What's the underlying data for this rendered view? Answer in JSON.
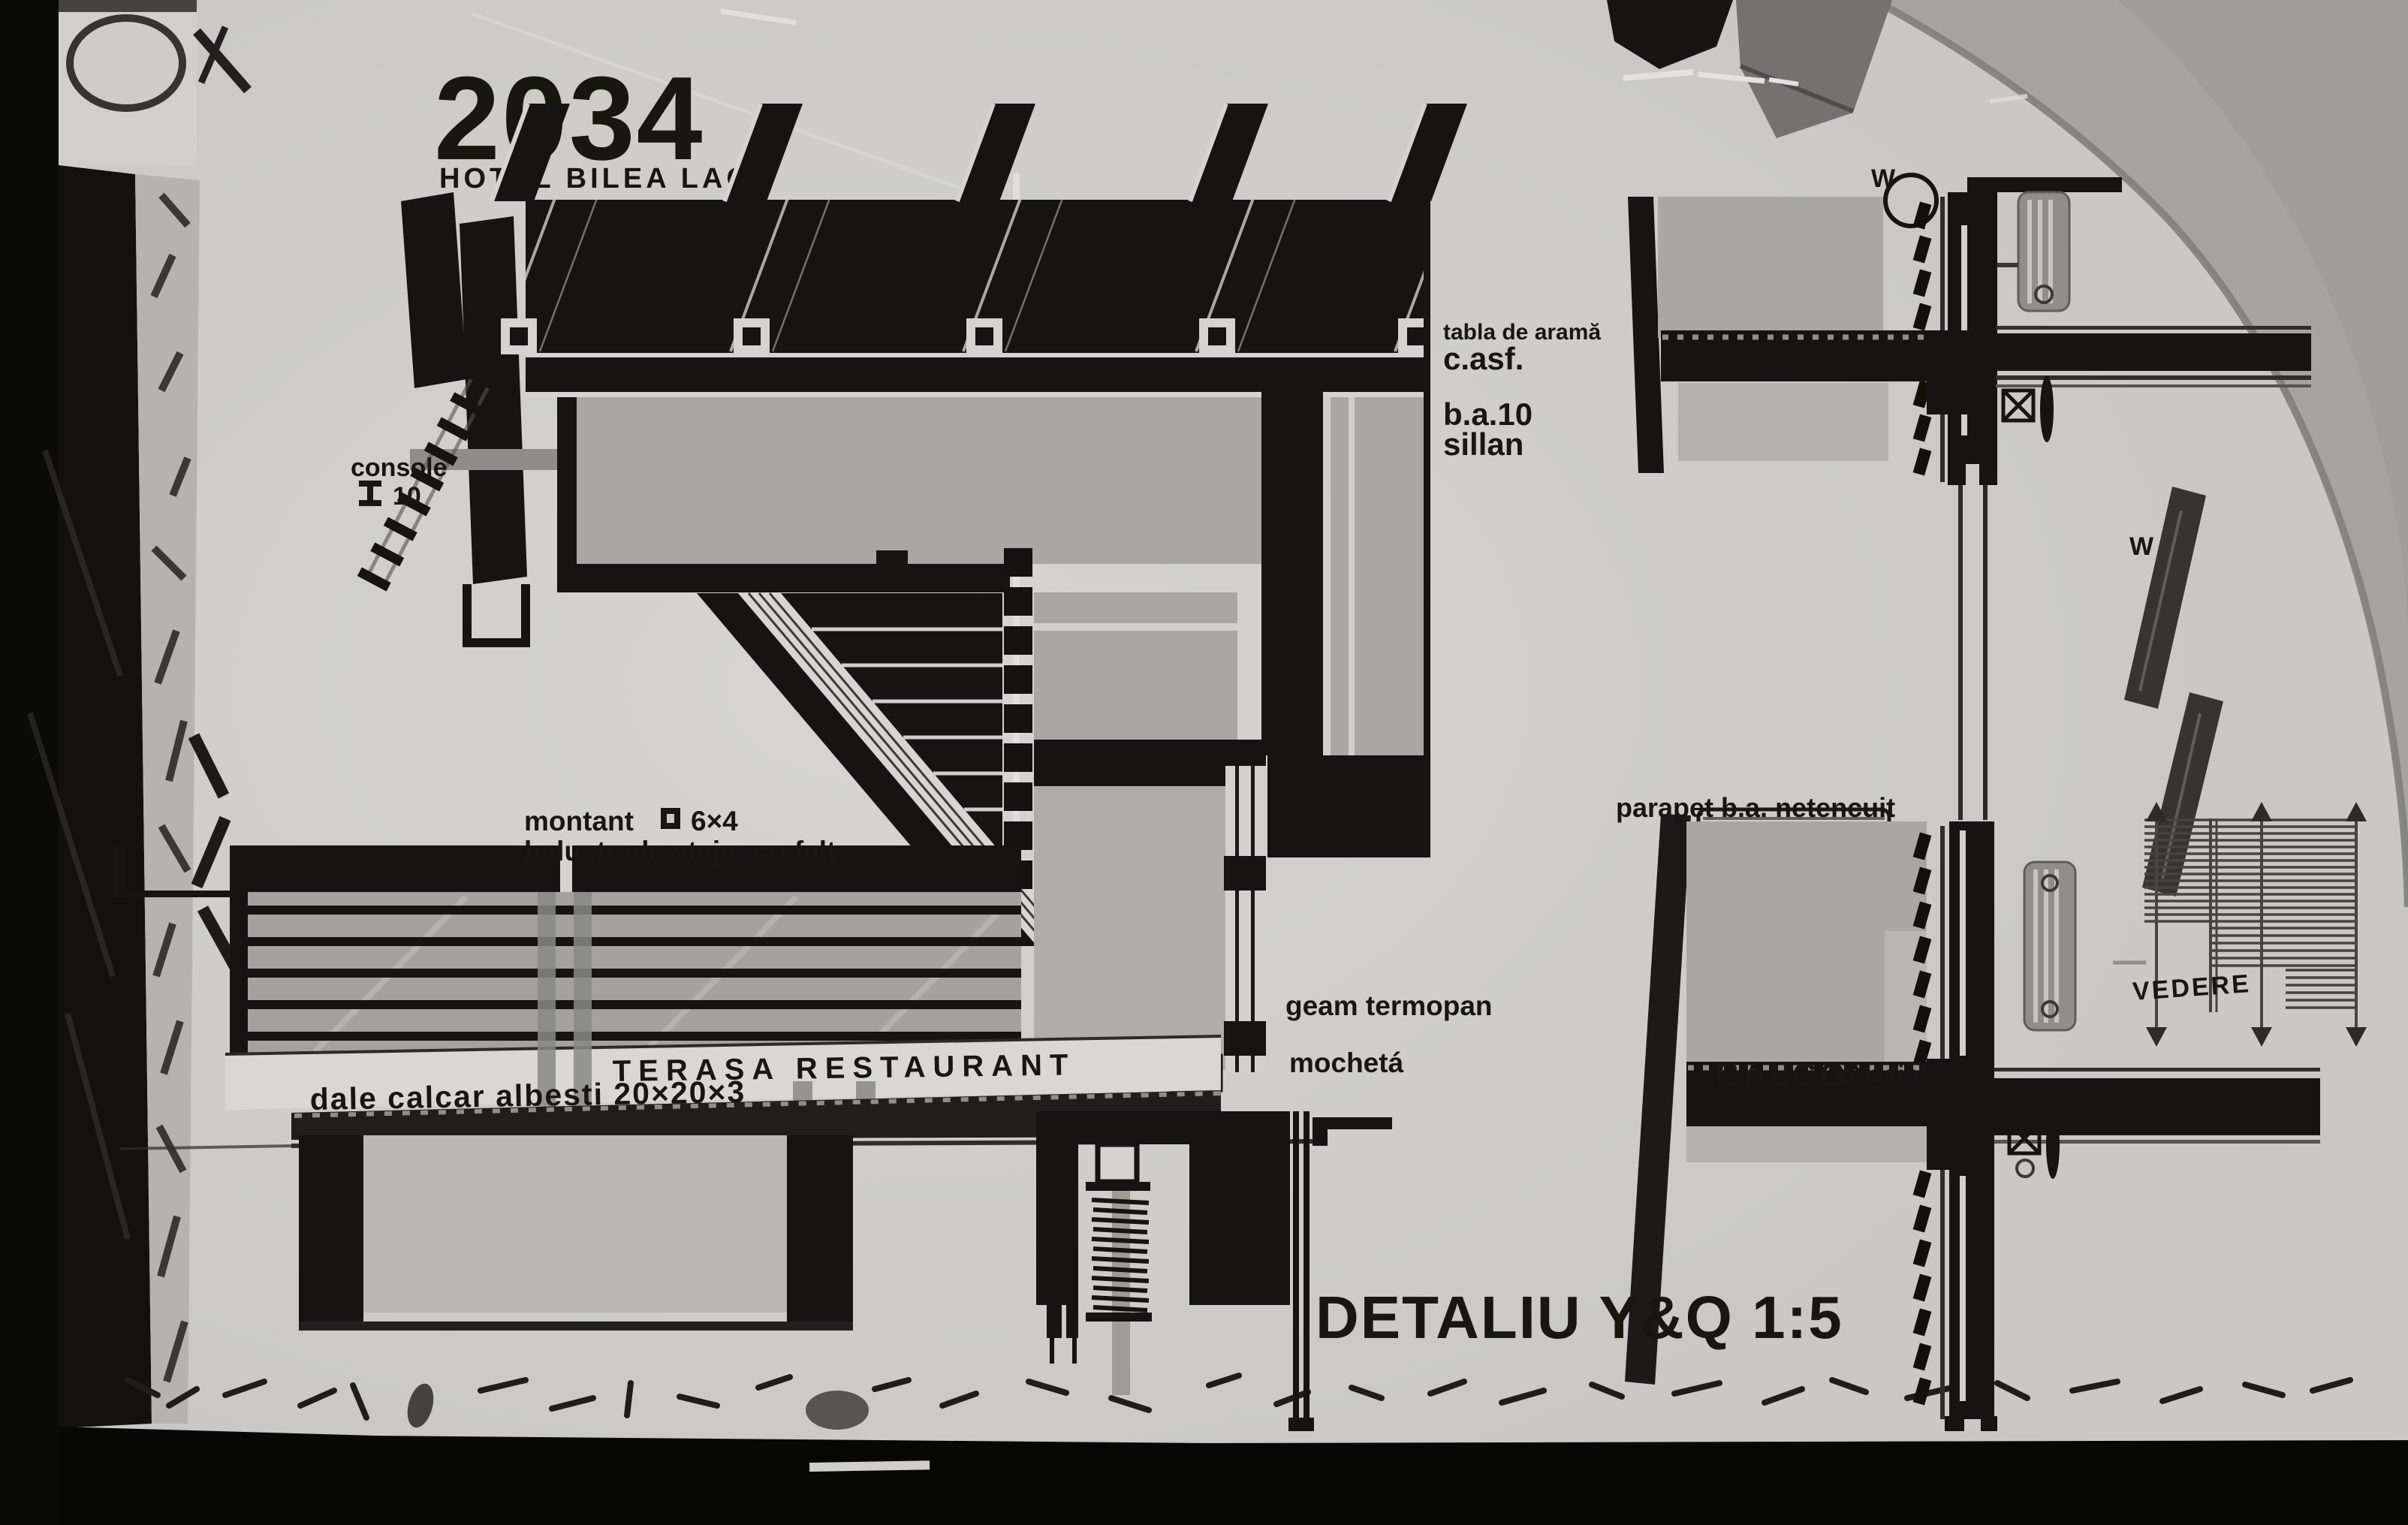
{
  "photo": {
    "title_number": "2034",
    "title_name": "HOTEL BILEA LAC",
    "detail_caption": "DETALIU Y&Q  1:5"
  },
  "annotations": {
    "console_line1": "console",
    "console_value": "10",
    "roof_note_1": "tabla de aramă",
    "roof_note_2": "c.asf.",
    "slab_note_1": "b.a.10",
    "slab_note_2": "sillan",
    "montant_label": "montant",
    "montant_size": "6×4",
    "balustrade_note": "balustrada stejar cu falț",
    "terrace_name": "TERASA RESTAURANT",
    "paving_note": "dale calcar albesti 20×20×3",
    "glazing_note": "geam termopan",
    "carpet_note": "mochetá",
    "parapet_note": "parapet b.a. netencuit",
    "balcony_name": "BALCON",
    "balcony_finish": "mozaic",
    "view_label": "VEDERE",
    "axis_w_upper": "W",
    "axis_w_mid": "W"
  },
  "colors": {
    "paper": "#c9c8c3",
    "ink": "#161412",
    "panel_gray": "#a8a7a2",
    "corner_gray": "#a5a4a0"
  }
}
